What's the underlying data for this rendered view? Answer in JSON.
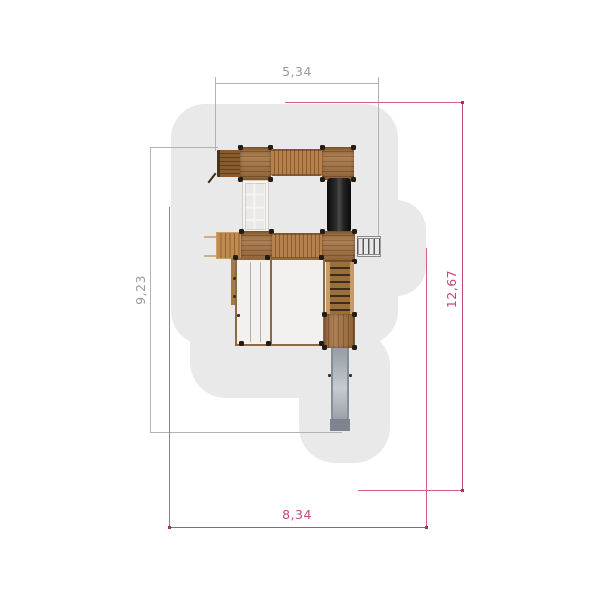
{
  "drawing": {
    "kind": "playground-equipment-top-view-plan",
    "dimensions": {
      "top": "5,34",
      "left": "9,23",
      "right": "12,67",
      "bottom": "8,34"
    },
    "dimension_styles": {
      "structure_dimension_color": "#9b9b9b",
      "safety_zone_dimension_color": "#c5487e"
    },
    "colors": {
      "background": "#ffffff",
      "safety_zone_fill": "#e9e9e9",
      "wood_platform": "#9c6b3d",
      "wood_plank_line": "#855830",
      "corner_post": "#241b12",
      "climbing_net": "#f7f4f0",
      "black_tube": "#141414",
      "metal_slide": "#aab0b7",
      "ground_frame_interior": "#f2f1ef"
    },
    "components": [
      "top-ramp",
      "tower-platform-a",
      "plank-bridge-1",
      "tower-platform-b",
      "climbing-net",
      "black-tube",
      "slat-ramp",
      "tower-platform-c",
      "plank-bridge-2",
      "tower-platform-d",
      "metal-ladder",
      "ground-frame",
      "staircase",
      "tower-platform-e",
      "metal-slide"
    ]
  }
}
